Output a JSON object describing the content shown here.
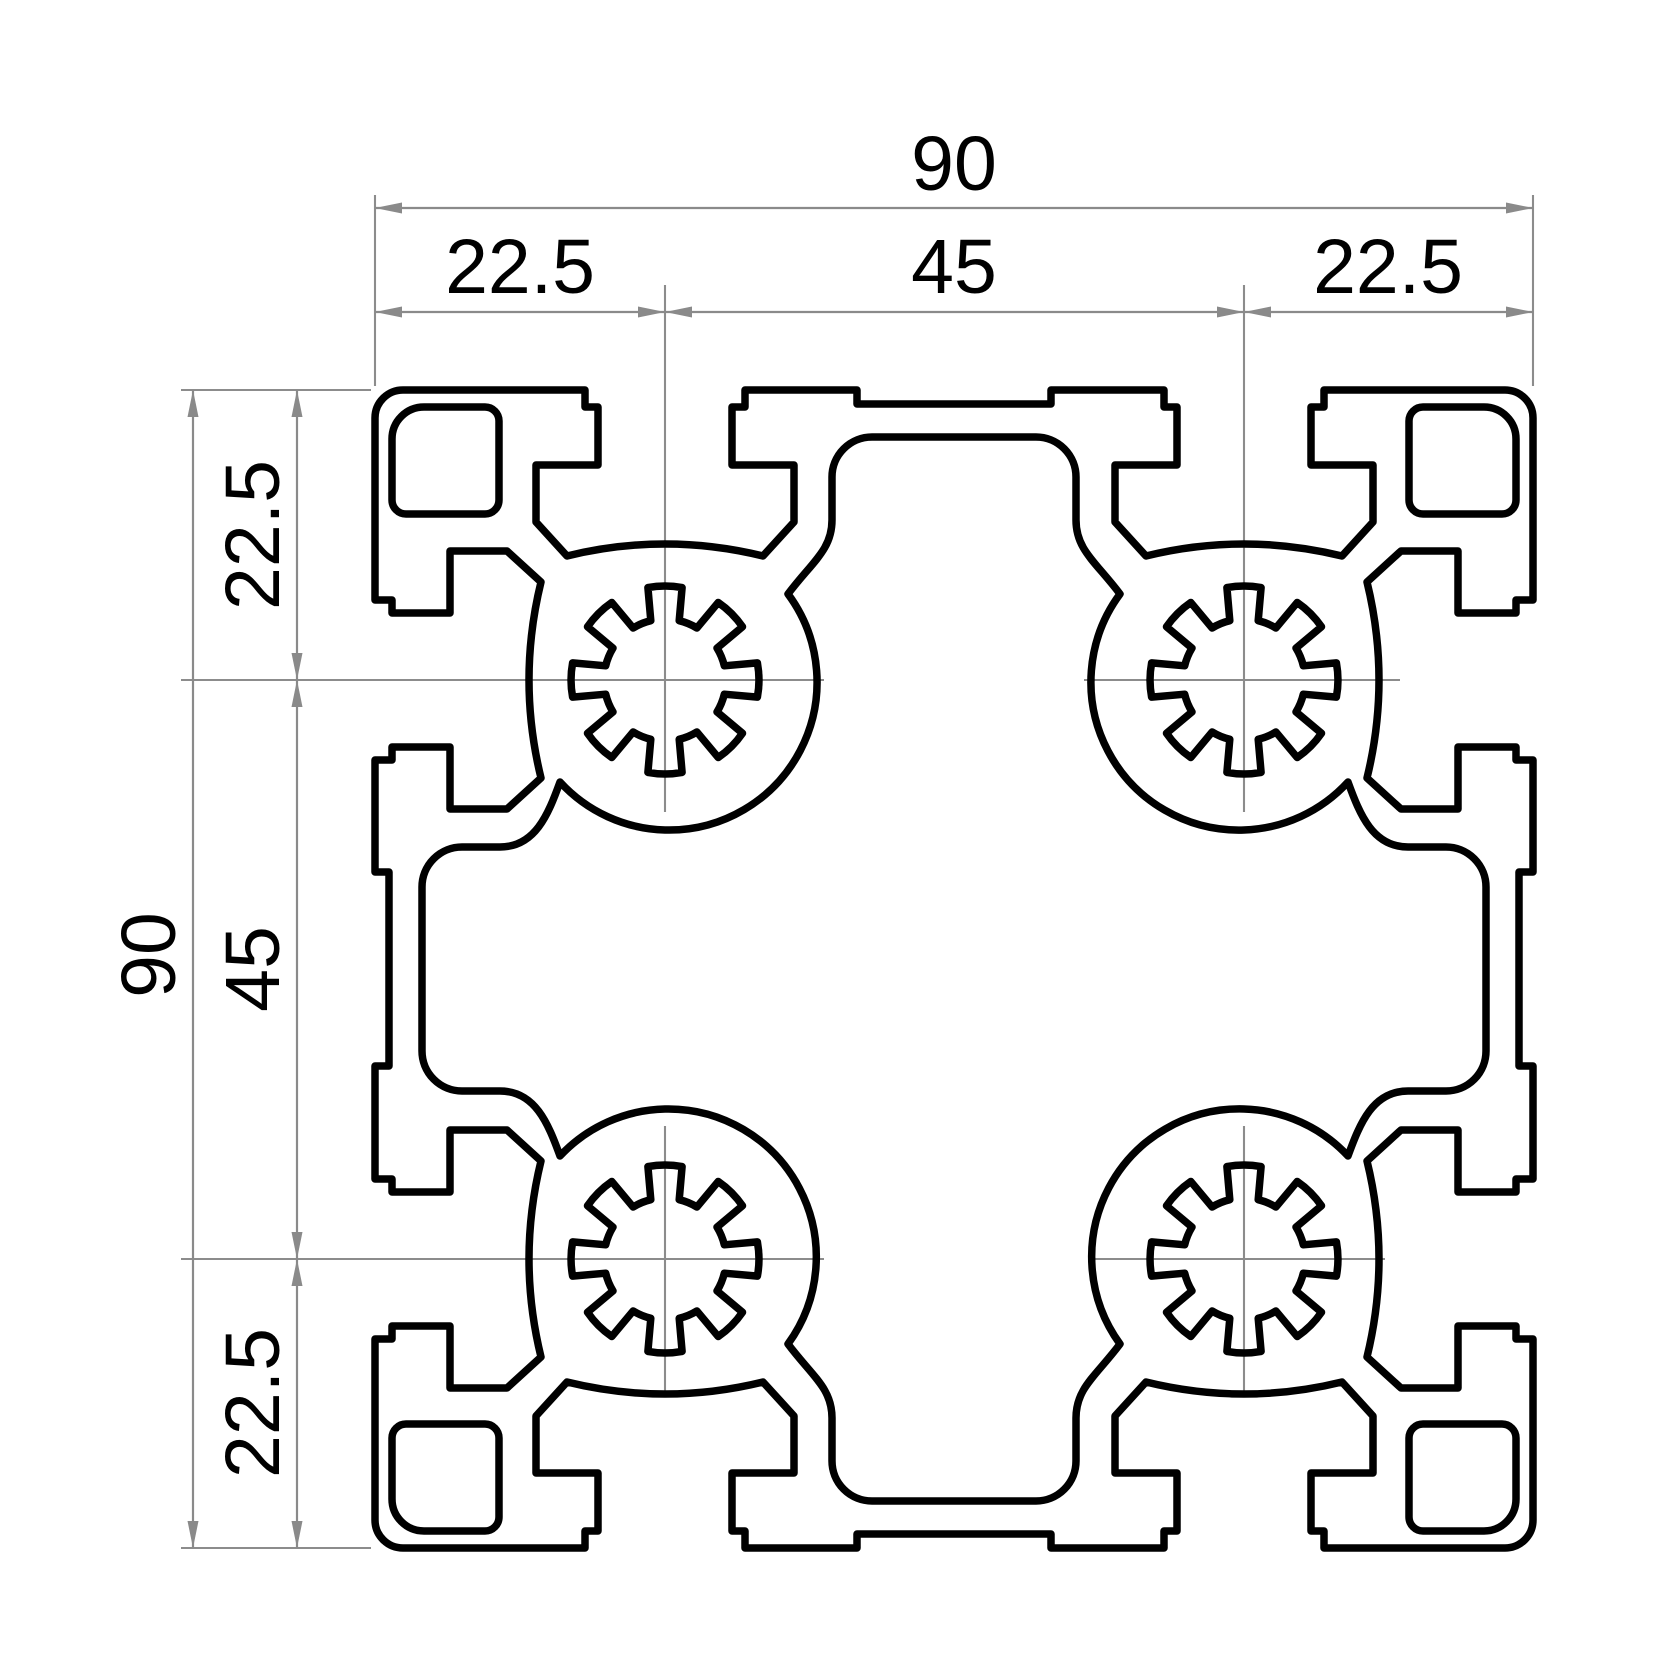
{
  "figure": {
    "type": "technical-drawing",
    "subject": "aluminum-extrusion-profile-cross-section",
    "profile_size": "90 x 90",
    "features": {
      "t_slots_per_side": 2,
      "serrated_screw_bores": 4,
      "corner_holes": 4,
      "central_cavity": "cross-shaped"
    }
  },
  "dimensions": {
    "top": {
      "total": "90",
      "segments": [
        "22.5",
        "45",
        "22.5"
      ]
    },
    "left": {
      "total": "90",
      "segments": [
        "22.5",
        "45",
        "22.5"
      ]
    }
  },
  "colors": {
    "background": "#ffffff",
    "outline": "#000000",
    "dimension_lines": "#8a8a8a",
    "centerlines": "#8c8c8c",
    "text": "#000000"
  }
}
